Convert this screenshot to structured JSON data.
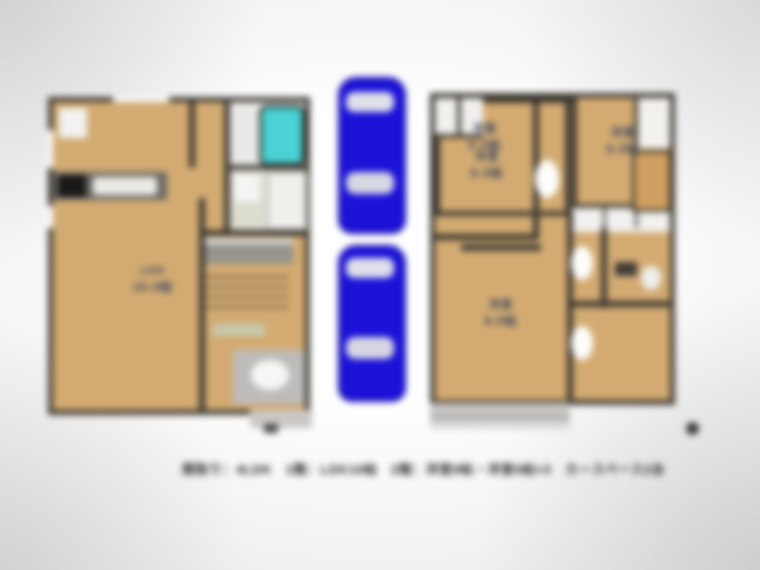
{
  "image": {
    "kind": "real-estate floor plan photo",
    "blurred": true
  },
  "caption": {
    "text": "間取り：4LDK　1階：LDK16帖　2階：洋室8帖・洋室6帖×3　カースペース2台"
  },
  "floor1": {
    "id": "1F",
    "ldk_label": {
      "line1": "LDK",
      "line2": "16.0帖"
    }
  },
  "floor2": {
    "id": "2F",
    "rooms": {
      "nw": {
        "line1": "洋室",
        "line2": "6.0帖"
      },
      "ne": {
        "line1": "洋室",
        "line2": "6.0帖"
      },
      "sw": {
        "line1": "洋室",
        "line2": "8.0帖"
      },
      "se": {
        "line1": "洋室",
        "line2": "6.0帖"
      }
    }
  },
  "parking": {
    "count": 2,
    "car_color": "#1c12d8"
  },
  "colors": {
    "floor_tan": "#d3ab72",
    "wall_dark": "#3d3831",
    "bathtub_cyan": "#4ad2d4",
    "balcony_gray": "#c6c5c3",
    "label_blue": "#32425e"
  }
}
